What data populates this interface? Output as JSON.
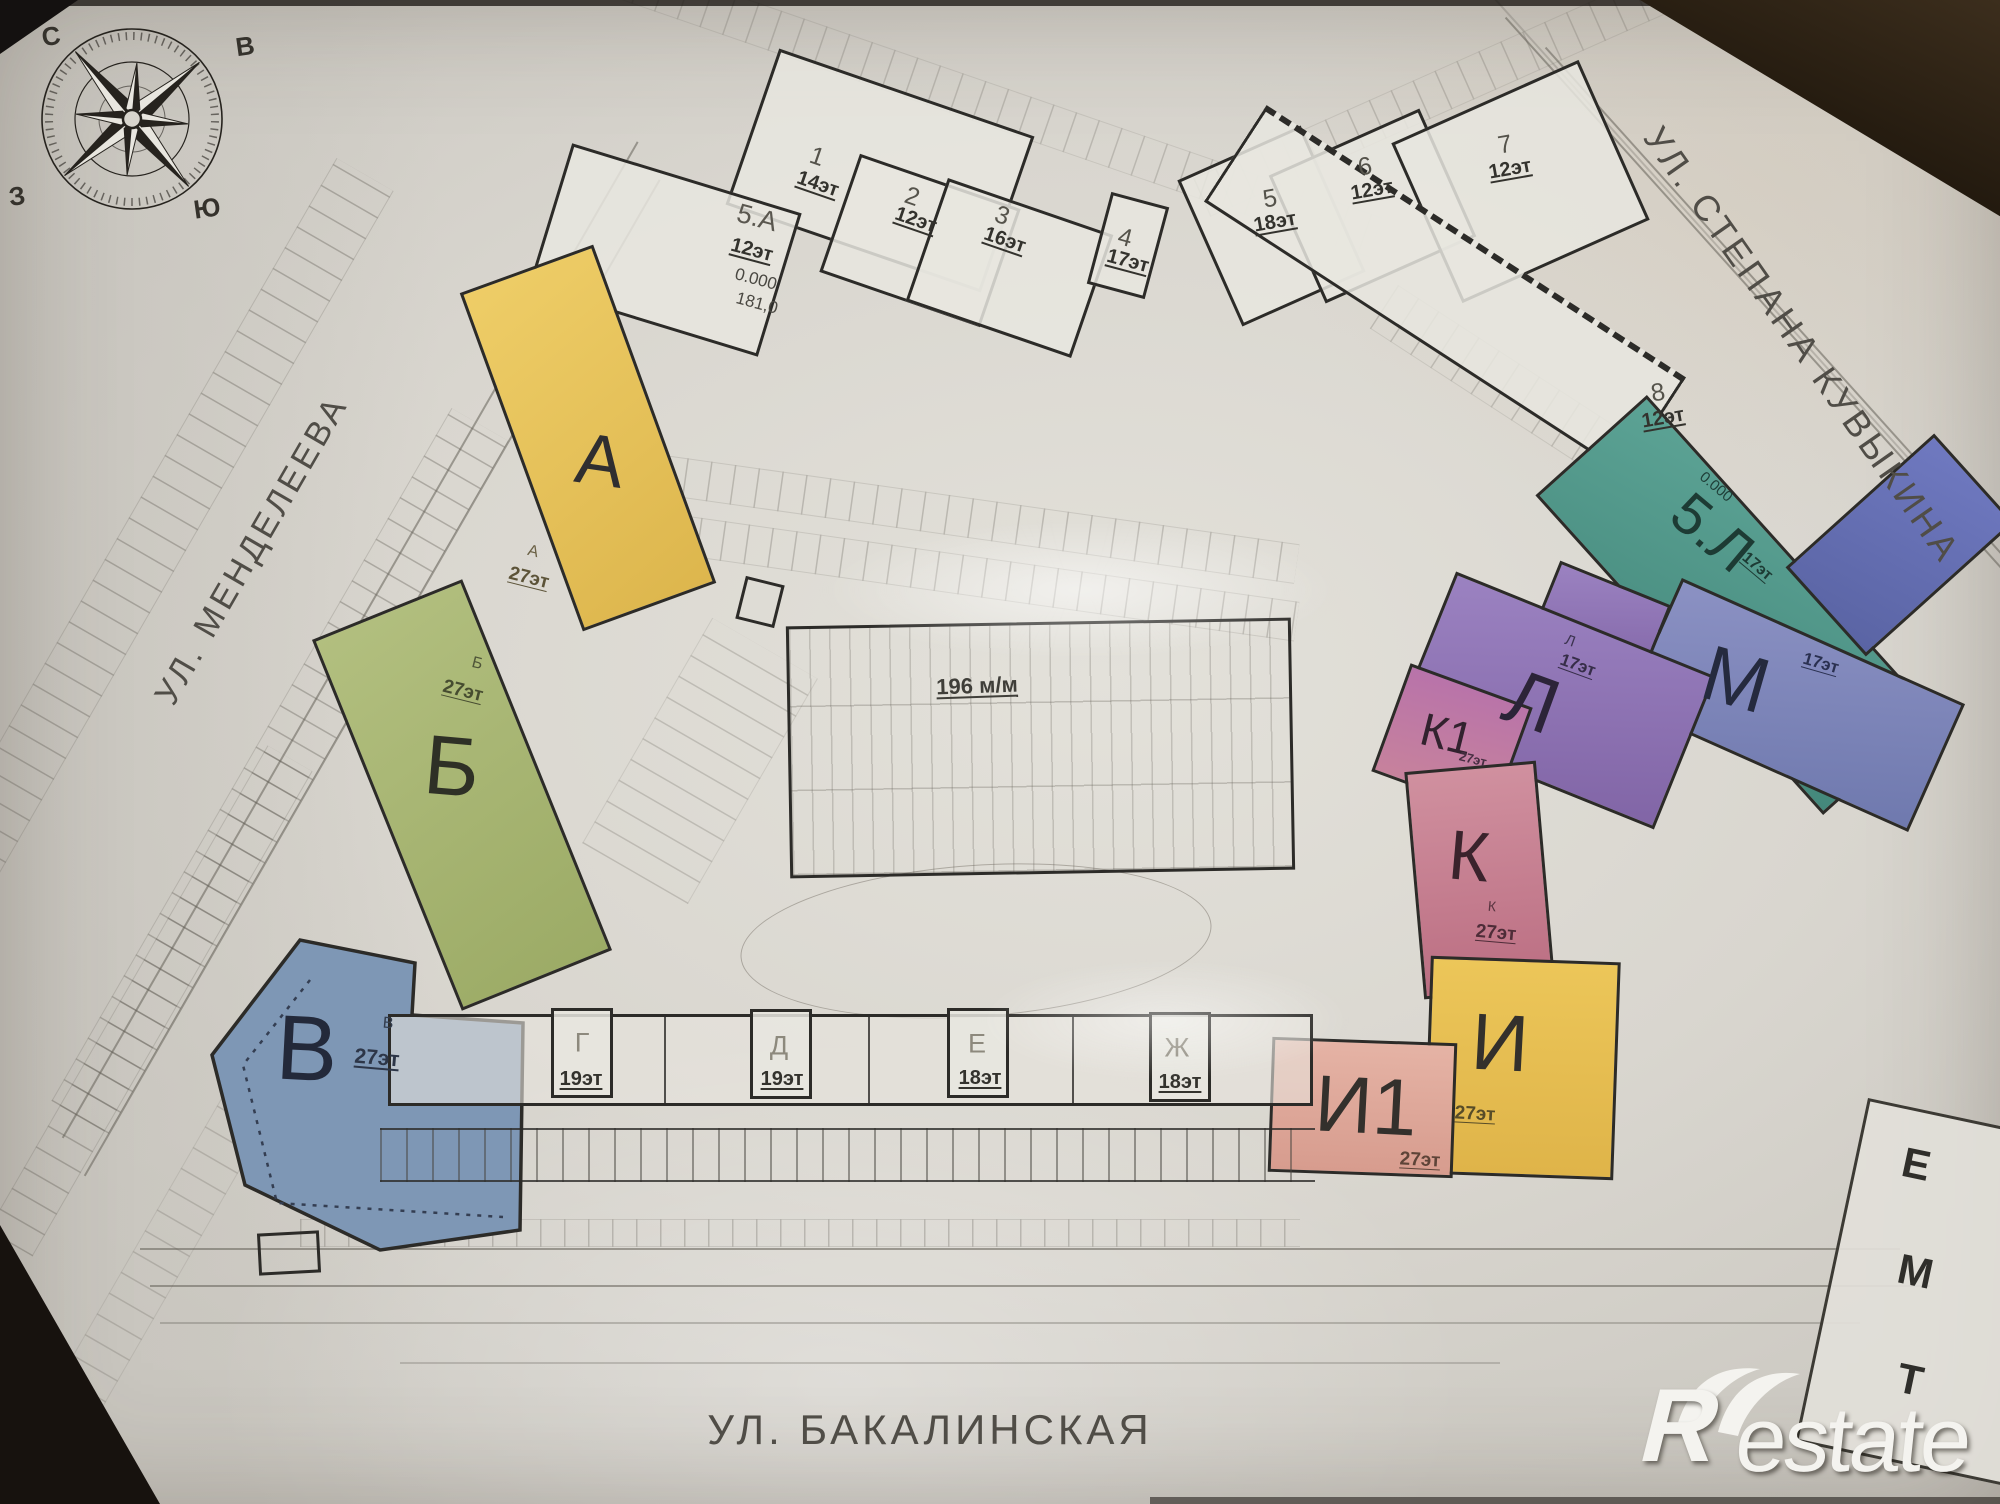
{
  "compass": {
    "n": "С",
    "e": "В",
    "s": "Ю",
    "w": "З"
  },
  "streets": {
    "mendeleeva": "УЛ. МЕНДЕЛЕЕВА",
    "kuvykina": "УЛ. СТЕПАНА КУВЫКИНА",
    "bakalinskaya": "УЛ. БАКАЛИНСКАЯ"
  },
  "parking": {
    "capacity": "196 м/м"
  },
  "towers": {
    "t1": {
      "num": "1",
      "floors": "14эт"
    },
    "t2": {
      "num": "2",
      "floors": "12эт"
    },
    "t3": {
      "num": "3",
      "floors": "16эт"
    },
    "t4": {
      "num": "4",
      "floors": "17эт"
    },
    "t5": {
      "num": "5",
      "floors": "18эт"
    },
    "t6": {
      "num": "6",
      "floors": "12эт"
    },
    "t7": {
      "num": "7",
      "floors": "12эт"
    },
    "t8": {
      "num": "8",
      "floors": "12эт"
    },
    "t5a": {
      "num": "5.А",
      "floors": "12эт",
      "level": "0.000",
      "mark": "181,0"
    },
    "t5l": {
      "num": "5.Л",
      "floors": "17эт",
      "level": "0.000"
    },
    "a": {
      "letter": "А",
      "floors": "27эт"
    },
    "b": {
      "letter": "Б",
      "floors": "27эт"
    },
    "v": {
      "letter": "В",
      "floors": "27эт"
    },
    "g": {
      "letter": "Г",
      "floors": "19эт"
    },
    "d": {
      "letter": "Д",
      "floors": "19эт"
    },
    "e": {
      "letter": "Е",
      "floors": "18эт"
    },
    "zh": {
      "letter": "Ж",
      "floors": "18эт"
    },
    "i": {
      "letter": "И",
      "floors": "27эт"
    },
    "i1": {
      "letter": "И1",
      "floors": "27эт"
    },
    "k": {
      "letter": "К",
      "floors": "27эт"
    },
    "k1": {
      "letter": "К1",
      "floors": "27эт"
    },
    "l": {
      "letter": "Л",
      "floors": "17эт"
    },
    "m": {
      "letter": "М",
      "floors": "17эт"
    }
  },
  "legend": {
    "row1": "Е",
    "row2": "М",
    "row3": "Т"
  },
  "brand": {
    "r": "R",
    "rest": "estate"
  },
  "colors": {
    "yellow": "#e6c35c",
    "green": "#a9b774",
    "blue": "#7e97b5",
    "salmon": "#dfa99a",
    "rose": "#c77f90",
    "magenta": "#b773a8",
    "purple": "#8a70b4",
    "violet": "#7c83ba",
    "teal": "#4f9b8d",
    "outline": "#2c2b28",
    "paper": "#d9d6cf"
  }
}
